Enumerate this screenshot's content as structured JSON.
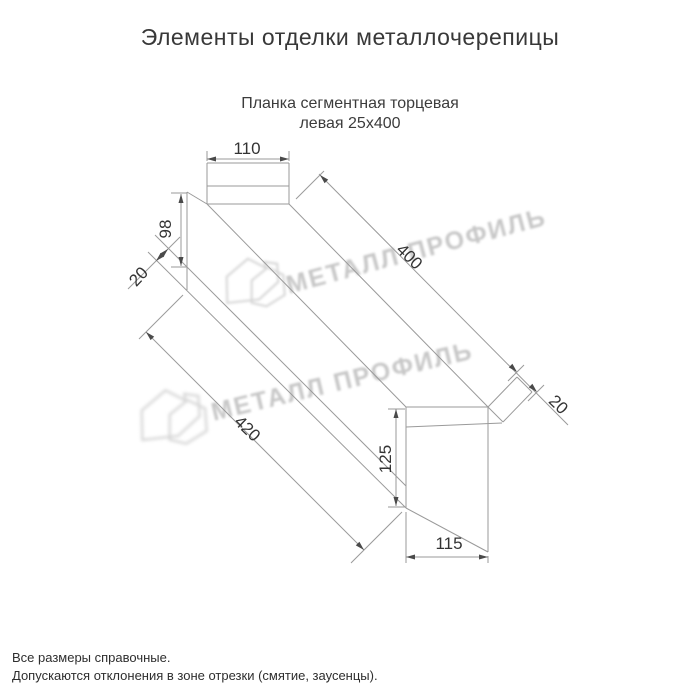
{
  "title": "Элементы отделки металлочерепицы",
  "subtitle": {
    "line1": "Планка сегментная торцевая",
    "line2": "левая 25х400"
  },
  "drawing": {
    "name": "Планка сегментная торцевая левая 25х400",
    "dimensions": {
      "top_flange_width": "110",
      "left_face_height": "98",
      "left_hem": "20",
      "length_top": "400",
      "right_hem": "20",
      "length_bottom": "420",
      "end_tab_height": "125",
      "end_tab_width": "115"
    }
  },
  "watermark": {
    "text": "МЕТАЛЛ ПРОФИЛЬ",
    "logo": "house-logo"
  },
  "footer": {
    "line1": "Все размеры справочные.",
    "line2": "Допускаются отклонения в зоне отрезки (смятие, заусенцы)."
  },
  "colors": {
    "background": "#ffffff",
    "drawing_line": "#9a9a9a",
    "arrow": "#4a4a4a",
    "dimension_text": "#333333",
    "title_text": "#383838",
    "watermark": "#c7c7c7"
  }
}
